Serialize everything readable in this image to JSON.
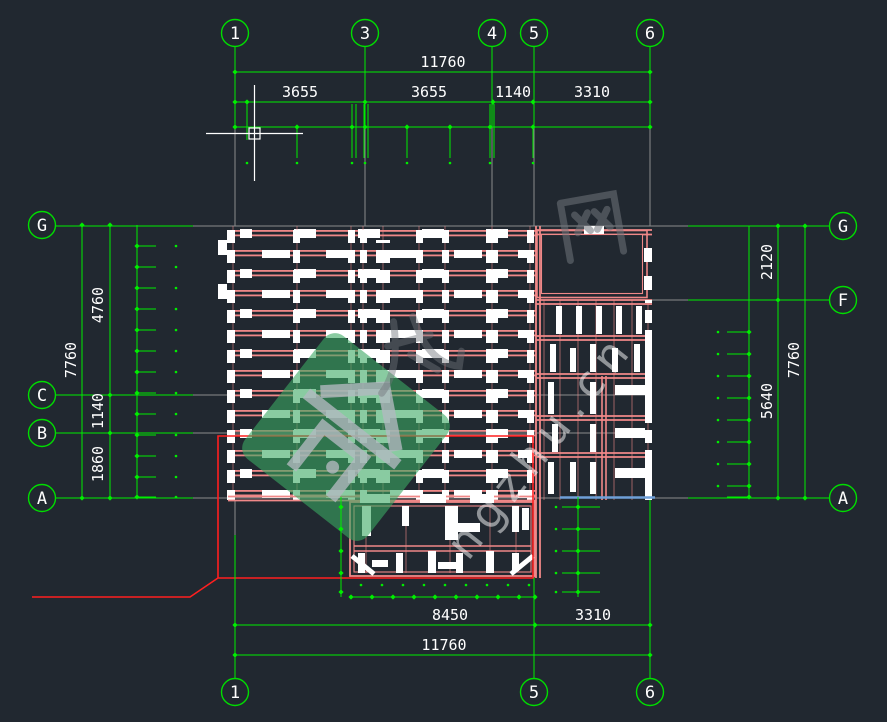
{
  "axes": {
    "top": [
      "1",
      "3",
      "4",
      "5",
      "6"
    ],
    "bottom": [
      "1",
      "5",
      "6"
    ],
    "left": [
      "G",
      "C",
      "B",
      "A"
    ],
    "right": [
      "G",
      "F",
      "A"
    ]
  },
  "dimensions": {
    "top": {
      "total": "11760",
      "segments": [
        "3655",
        "3655",
        "1140",
        "3310"
      ]
    },
    "bottom": {
      "segments": [
        "8450",
        "3310"
      ],
      "total": "11760"
    },
    "left": {
      "total": "7760",
      "segments": [
        "4760",
        "1140",
        "1860"
      ]
    },
    "right": {
      "segments": [
        "2120",
        "5640"
      ],
      "total": "7760"
    }
  },
  "watermark": {
    "char": "网",
    "text": "ngzhu.cn"
  },
  "colors": {
    "background": "#212830",
    "dimension_green": "#00ee00",
    "beam_pink": "#f08888",
    "outline_red": "#ff1f1f",
    "axis_gray": "#8c8c8c",
    "drawing_white": "#ffffff",
    "aux_blue": "#6f9fd8",
    "watermark_green": "#3aa862",
    "watermark_gray": "#70757b"
  }
}
